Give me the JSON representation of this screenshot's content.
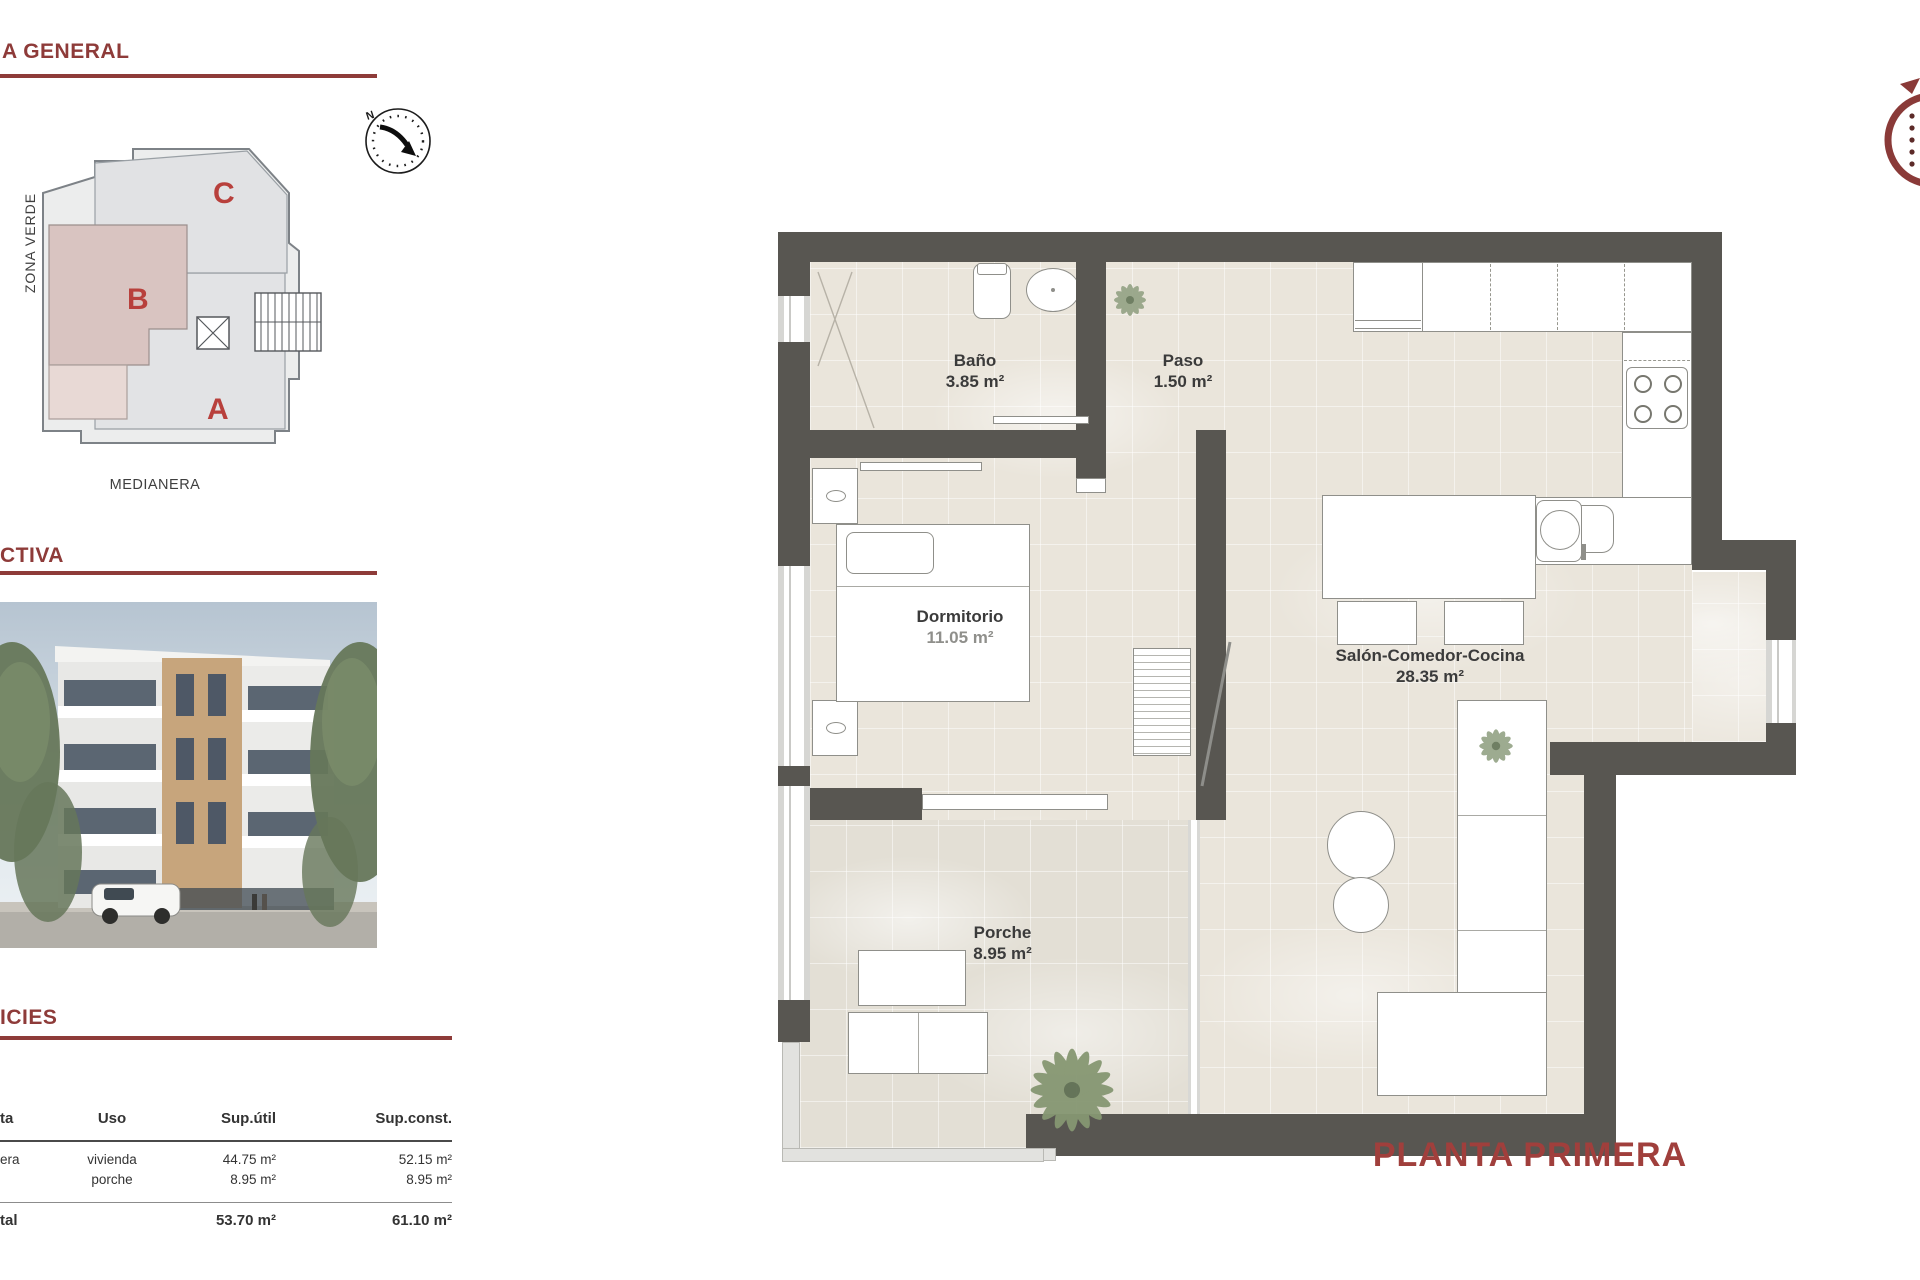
{
  "colors": {
    "accent": "#8e3b39",
    "wall": "#585651",
    "letter": "#b8403c",
    "title": "#a03f3c"
  },
  "headings": {
    "general": "A GENERAL",
    "perspective": "CTIVA",
    "surfaces": "ICIES"
  },
  "site_plan": {
    "zona_verde": "ZONA VERDE",
    "medianera": "MEDIANERA",
    "compass_north": "N",
    "sections": {
      "c": "C",
      "b": "B",
      "a": "A"
    }
  },
  "floor_plan": {
    "title": "PLANTA PRIMERA",
    "rooms": {
      "bano": {
        "name": "Baño",
        "area": "3.85 m²"
      },
      "paso": {
        "name": "Paso",
        "area": "1.50 m²"
      },
      "dormitorio": {
        "name": "Dormitorio",
        "area": "11.05 m²"
      },
      "salon": {
        "name": "Salón-Comedor-Cocina",
        "area": "28.35 m²"
      },
      "porche": {
        "name": "Porche",
        "area": "8.95 m²"
      }
    }
  },
  "surfaces_table": {
    "headers": {
      "planta": "ta",
      "uso": "Uso",
      "util": "Sup.útil",
      "const": "Sup.const."
    },
    "row": {
      "planta": "era",
      "uso1": "vivienda",
      "uso2": "porche",
      "util1": "44.75 m²",
      "util2": "8.95 m²",
      "const1": "52.15 m²",
      "const2": "8.95 m²"
    },
    "total": {
      "label": "tal",
      "util": "53.70 m²",
      "const": "61.10 m²"
    }
  }
}
